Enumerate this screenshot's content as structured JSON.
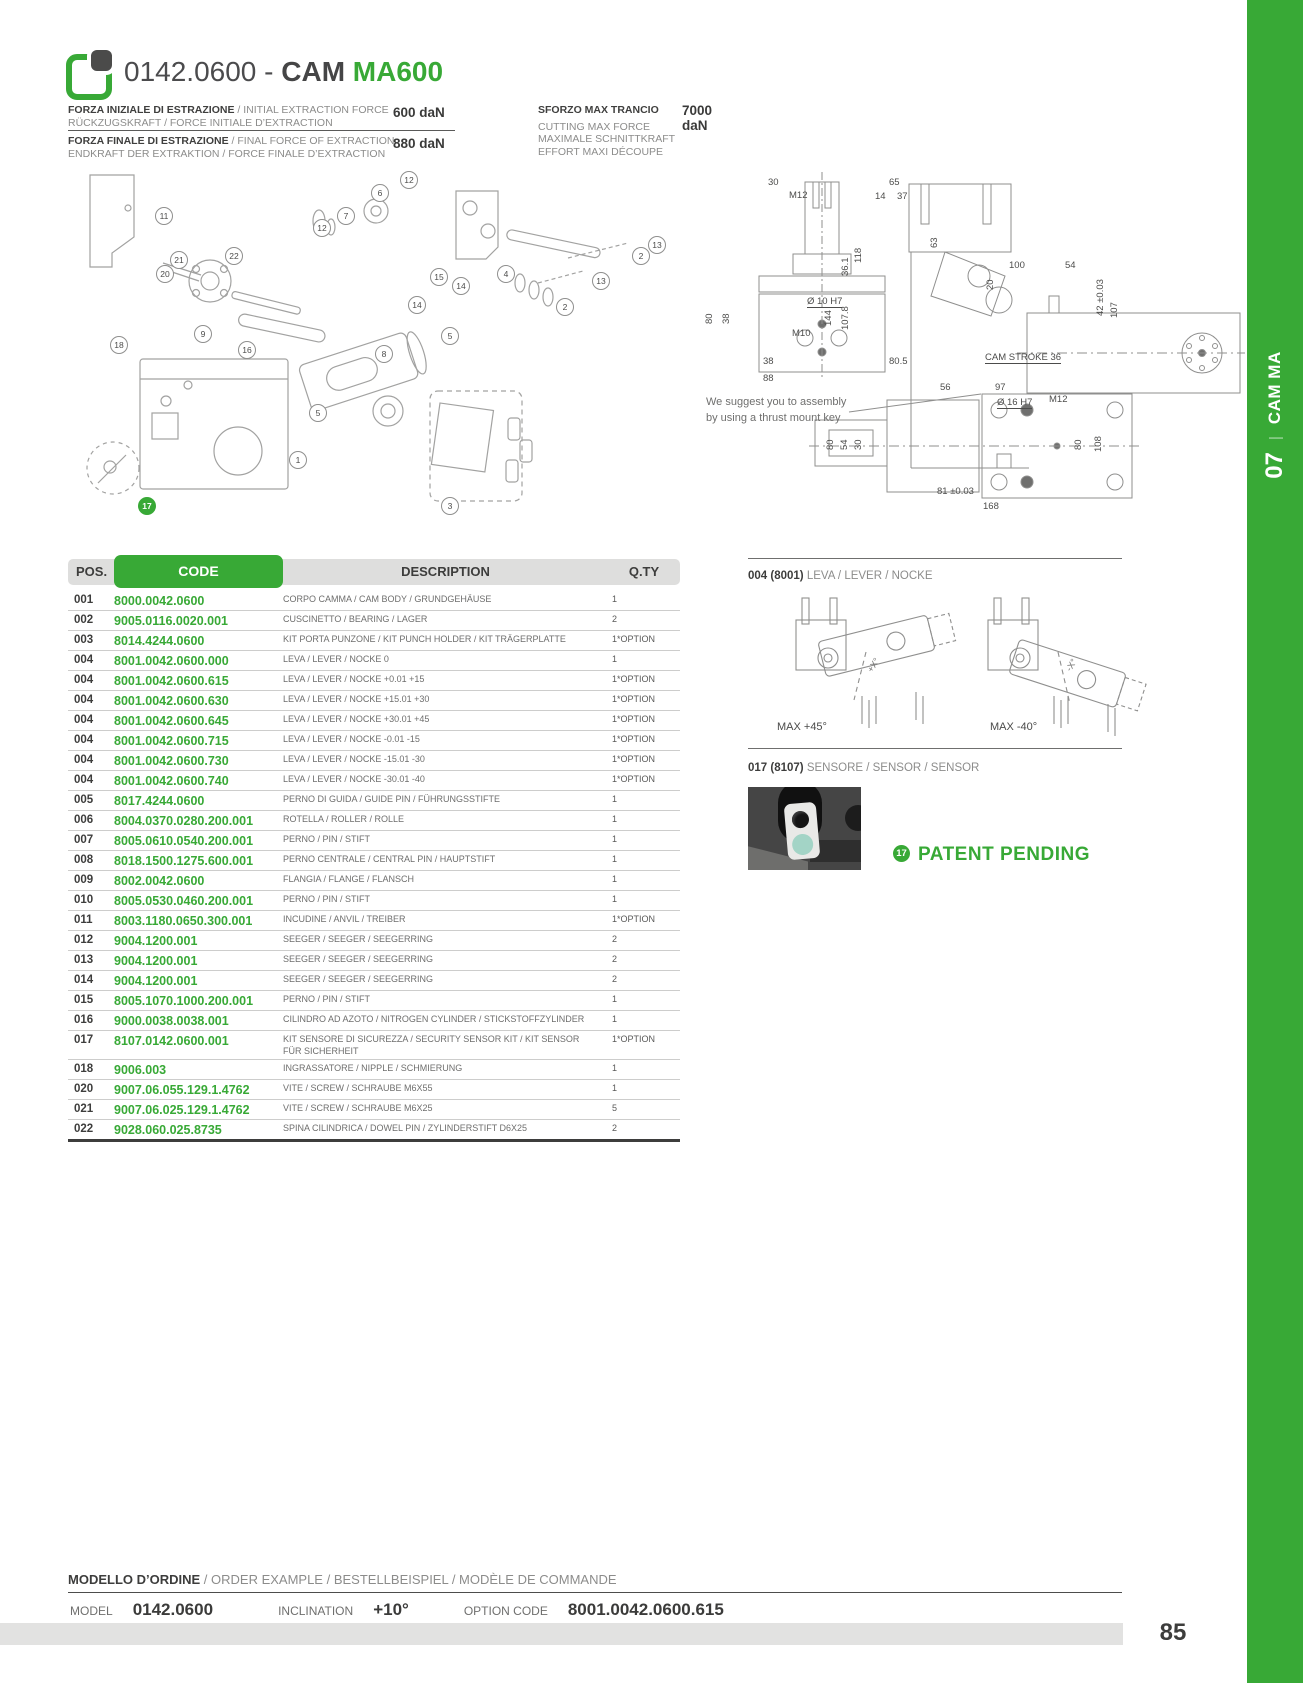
{
  "colors": {
    "green": "#38a936",
    "dark": "#3d3d3c",
    "gray": "#8c8c8b"
  },
  "sidebar": {
    "group": "CAM MA",
    "separator": "|",
    "number": "07"
  },
  "header": {
    "code": "0142.0600 -",
    "cam": "CAM",
    "model": "MA600"
  },
  "specs": {
    "rows": [
      {
        "bold": "FORZA INIZIALE DI ESTRAZIONE",
        "rest": " / INITIAL EXTRACTION FORCE",
        "line2": "RÜCKZUGSKRAFT / FORCE INITIALE D’EXTRACTION",
        "value": "600 daN"
      },
      {
        "bold": "FORZA FINALE DI ESTRAZIONE",
        "rest": " / FINAL FORCE OF EXTRACTION",
        "line2": "ENDKRAFT DER EXTRAKTION / FORCE FINALE D’EXTRACTION",
        "value": "880 daN"
      }
    ],
    "max": {
      "bold": "SFORZO MAX TRANCIO",
      "value": "7000 daN",
      "lines": [
        "CUTTING MAX FORCE",
        "MAXIMALE SCHNITTKRAFT",
        "EFFORT MAXI DÉCOUPE"
      ]
    }
  },
  "exploded": {
    "balloons": [
      {
        "n": "11",
        "x": 87,
        "y": 44
      },
      {
        "n": "6",
        "x": 303,
        "y": 21
      },
      {
        "n": "12",
        "x": 332,
        "y": 8
      },
      {
        "n": "7",
        "x": 269,
        "y": 44
      },
      {
        "n": "12",
        "x": 245,
        "y": 56
      },
      {
        "n": "22",
        "x": 157,
        "y": 84
      },
      {
        "n": "21",
        "x": 102,
        "y": 88
      },
      {
        "n": "20",
        "x": 88,
        "y": 102
      },
      {
        "n": "9",
        "x": 126,
        "y": 162
      },
      {
        "n": "16",
        "x": 170,
        "y": 178
      },
      {
        "n": "18",
        "x": 42,
        "y": 173
      },
      {
        "n": "8",
        "x": 307,
        "y": 182
      },
      {
        "n": "5",
        "x": 373,
        "y": 164
      },
      {
        "n": "5",
        "x": 241,
        "y": 241
      },
      {
        "n": "1",
        "x": 221,
        "y": 288
      },
      {
        "n": "17",
        "x": 70,
        "y": 334,
        "g": 1
      },
      {
        "n": "3",
        "x": 373,
        "y": 334
      },
      {
        "n": "4",
        "x": 429,
        "y": 102
      },
      {
        "n": "15",
        "x": 362,
        "y": 105
      },
      {
        "n": "14",
        "x": 384,
        "y": 114
      },
      {
        "n": "14",
        "x": 340,
        "y": 133
      },
      {
        "n": "13",
        "x": 580,
        "y": 73
      },
      {
        "n": "2",
        "x": 564,
        "y": 84
      },
      {
        "n": "13",
        "x": 524,
        "y": 109
      },
      {
        "n": "2",
        "x": 488,
        "y": 135
      }
    ]
  },
  "drawing": {
    "note1": "We suggest you to assembly",
    "note2": "by using a thrust mount key",
    "labels": [
      {
        "t": "30",
        "x": 71,
        "y": 9
      },
      {
        "t": "M12",
        "x": 92,
        "y": 22
      },
      {
        "t": "80",
        "x": 7,
        "y": 156,
        "r": 1
      },
      {
        "t": "38",
        "x": 24,
        "y": 156,
        "r": 1
      },
      {
        "t": "Ø 10 H7",
        "x": 110,
        "y": 128,
        "u": 1
      },
      {
        "t": "M10",
        "x": 95,
        "y": 160
      },
      {
        "t": "38",
        "x": 66,
        "y": 188
      },
      {
        "t": "88",
        "x": 66,
        "y": 205
      },
      {
        "t": "65",
        "x": 192,
        "y": 9
      },
      {
        "t": "14",
        "x": 178,
        "y": 23
      },
      {
        "t": "37",
        "x": 200,
        "y": 23
      },
      {
        "t": "63",
        "x": 232,
        "y": 80,
        "r": 1
      },
      {
        "t": "118",
        "x": 156,
        "y": 95,
        "r": 1
      },
      {
        "t": "36.1",
        "x": 143,
        "y": 108,
        "r": 1
      },
      {
        "t": "144",
        "x": 126,
        "y": 158,
        "r": 1
      },
      {
        "t": "107.8",
        "x": 143,
        "y": 162,
        "r": 1
      },
      {
        "t": "80.5",
        "x": 192,
        "y": 188
      },
      {
        "t": "100",
        "x": 312,
        "y": 92
      },
      {
        "t": "54",
        "x": 368,
        "y": 92
      },
      {
        "t": "20",
        "x": 288,
        "y": 122,
        "r": 1
      },
      {
        "t": "42 ±0.03",
        "x": 398,
        "y": 148,
        "r": 1
      },
      {
        "t": "107",
        "x": 412,
        "y": 150,
        "r": 1
      },
      {
        "t": "CAM STROKE 36",
        "x": 288,
        "y": 184,
        "u": 1
      },
      {
        "t": "56",
        "x": 243,
        "y": 214
      },
      {
        "t": "97",
        "x": 298,
        "y": 214
      },
      {
        "t": "Ø 16 H7",
        "x": 300,
        "y": 229,
        "u": 1
      },
      {
        "t": "M12",
        "x": 352,
        "y": 226
      },
      {
        "t": "80",
        "x": 128,
        "y": 282,
        "r": 1
      },
      {
        "t": "54",
        "x": 142,
        "y": 282,
        "r": 1
      },
      {
        "t": "30",
        "x": 156,
        "y": 282,
        "r": 1
      },
      {
        "t": "80",
        "x": 376,
        "y": 282,
        "r": 1
      },
      {
        "t": "108",
        "x": 396,
        "y": 284,
        "r": 1
      },
      {
        "t": "81 ±0.03",
        "x": 240,
        "y": 318
      },
      {
        "t": "168",
        "x": 286,
        "y": 333
      }
    ]
  },
  "table": {
    "headers": [
      "POS.",
      "CODE",
      "DESCRIPTION",
      "Q.TY"
    ],
    "rows": [
      [
        "001",
        "8000.0042.0600",
        "CORPO CAMMA / CAM BODY / GRUNDGEHÄUSE",
        "1"
      ],
      [
        "002",
        "9005.0116.0020.001",
        "CUSCINETTO / BEARING / LAGER",
        "2"
      ],
      [
        "003",
        "8014.4244.0600",
        "KIT PORTA PUNZONE / KIT PUNCH HOLDER / KIT TRÄGERPLATTE",
        "1*OPTION"
      ],
      [
        "004",
        "8001.0042.0600.000",
        "LEVA / LEVER / NOCKE 0",
        "1"
      ],
      [
        "004",
        "8001.0042.0600.615",
        "LEVA / LEVER / NOCKE +0.01 +15",
        "1*OPTION"
      ],
      [
        "004",
        "8001.0042.0600.630",
        "LEVA / LEVER / NOCKE +15.01 +30",
        "1*OPTION"
      ],
      [
        "004",
        "8001.0042.0600.645",
        "LEVA / LEVER / NOCKE +30.01 +45",
        "1*OPTION"
      ],
      [
        "004",
        "8001.0042.0600.715",
        "LEVA / LEVER / NOCKE -0.01 -15",
        "1*OPTION"
      ],
      [
        "004",
        "8001.0042.0600.730",
        "LEVA / LEVER / NOCKE -15.01 -30",
        "1*OPTION"
      ],
      [
        "004",
        "8001.0042.0600.740",
        "LEVA / LEVER / NOCKE -30.01 -40",
        "1*OPTION"
      ],
      [
        "005",
        "8017.4244.0600",
        "PERNO DI GUIDA / GUIDE PIN / FÜHRUNGSSTIFTE",
        "1"
      ],
      [
        "006",
        "8004.0370.0280.200.001",
        "ROTELLA / ROLLER / ROLLE",
        "1"
      ],
      [
        "007",
        "8005.0610.0540.200.001",
        "PERNO / PIN / STIFT",
        "1"
      ],
      [
        "008",
        "8018.1500.1275.600.001",
        "PERNO CENTRALE / CENTRAL PIN / HAUPTSTIFT",
        "1"
      ],
      [
        "009",
        "8002.0042.0600",
        "FLANGIA / FLANGE / FLANSCH",
        "1"
      ],
      [
        "010",
        "8005.0530.0460.200.001",
        "PERNO / PIN / STIFT",
        "1"
      ],
      [
        "011",
        "8003.1180.0650.300.001",
        "INCUDINE / ANVIL / TREIBER",
        "1*OPTION"
      ],
      [
        "012",
        "9004.1200.001",
        "SEEGER / SEEGER / SEEGERRING",
        "2"
      ],
      [
        "013",
        "9004.1200.001",
        "SEEGER / SEEGER / SEEGERRING",
        "2"
      ],
      [
        "014",
        "9004.1200.001",
        "SEEGER / SEEGER / SEEGERRING",
        "2"
      ],
      [
        "015",
        "8005.1070.1000.200.001",
        "PERNO / PIN / STIFT",
        "1"
      ],
      [
        "016",
        "9000.0038.0038.001",
        "CILINDRO AD AZOTO / NITROGEN CYLINDER / STICKSTOFFZYLINDER",
        "1"
      ],
      [
        "017",
        "8107.0142.0600.001",
        "KIT SENSORE DI SICUREZZA / SECURITY SENSOR KIT / KIT SENSOR FÜR SICHERHEIT",
        "1*OPTION"
      ],
      [
        "018",
        "9006.003",
        "INGRASSATORE / NIPPLE / SCHMIERUNG",
        "1"
      ],
      [
        "020",
        "9007.06.055.129.1.4762",
        "VITE / SCREW / SCHRAUBE M6X55",
        "1"
      ],
      [
        "021",
        "9007.06.025.129.1.4762",
        "VITE / SCREW / SCHRAUBE M6X25",
        "5"
      ],
      [
        "022",
        "9028.060.025.8735",
        "SPINA CILINDRICA / DOWEL PIN / ZYLINDERSTIFT D6X25",
        "2"
      ]
    ]
  },
  "lever": {
    "title_bold": "004 (8001)",
    "title_rest": " LEVA / LEVER / NOCKE",
    "label_left": "MAX +45°",
    "label_right": "MAX -40°",
    "axis_left": "+X°",
    "axis_right": "-X°"
  },
  "sensor": {
    "title_bold": "017 (8107)",
    "title_rest": " SENSORE / SENSOR / SENSOR",
    "badge": "17",
    "patent": "PATENT PENDING"
  },
  "order": {
    "title_bold": "MODELLO D’ORDINE",
    "title_rest": " / ORDER EXAMPLE / BESTELLBEISPIEL / MODÈLE DE COMMANDE",
    "fields": [
      {
        "label": "MODEL",
        "value": "0142.0600"
      },
      {
        "label": "INCLINATION",
        "value": "+10°"
      },
      {
        "label": "OPTION CODE",
        "value": "8001.0042.0600.615"
      }
    ]
  },
  "page": {
    "number": "85"
  }
}
